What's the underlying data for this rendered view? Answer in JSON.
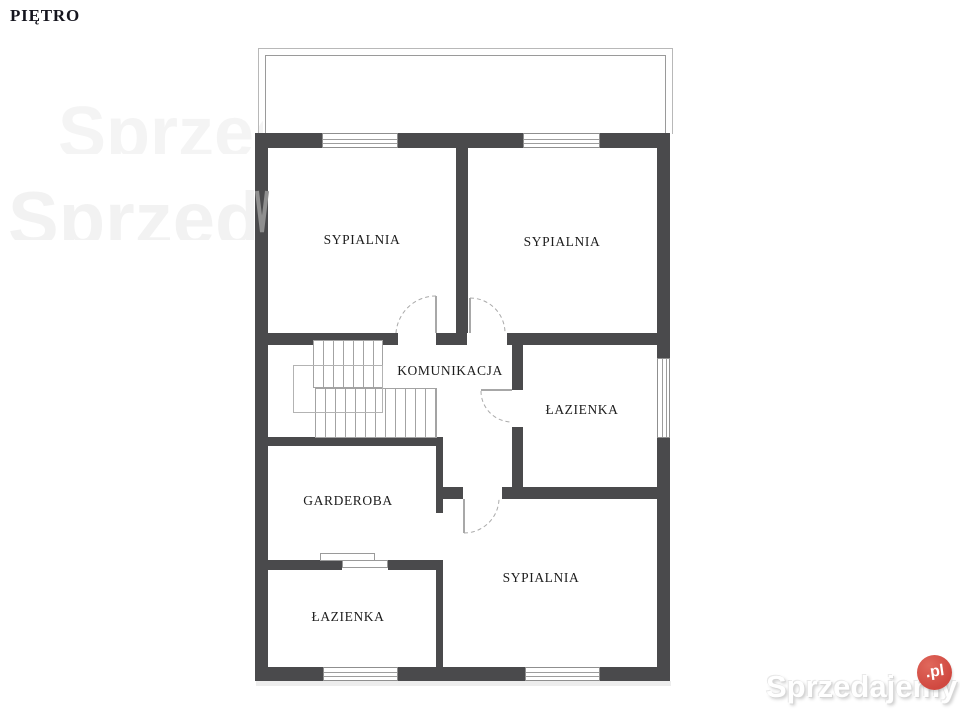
{
  "title": "PIĘTRO",
  "plan": {
    "wall_color": "#4a4a4c",
    "rooms": [
      {
        "id": "bedroom-top-left",
        "label": "SYPIALNIA"
      },
      {
        "id": "bedroom-top-right",
        "label": "SYPIALNIA"
      },
      {
        "id": "hallway",
        "label": "KOMUNIKACJA"
      },
      {
        "id": "bathroom-middle",
        "label": "ŁAZIENKA"
      },
      {
        "id": "wardrobe",
        "label": "GARDEROBA"
      },
      {
        "id": "bathroom-bottom",
        "label": "ŁAZIENKA"
      },
      {
        "id": "bedroom-bottom",
        "label": "SYPIALNIA"
      }
    ]
  },
  "watermark": {
    "brand": "Sprzedajemy",
    "tld": ".pl",
    "badge_color": "#d5524a",
    "background_fragment": "Sprzedajemy"
  }
}
